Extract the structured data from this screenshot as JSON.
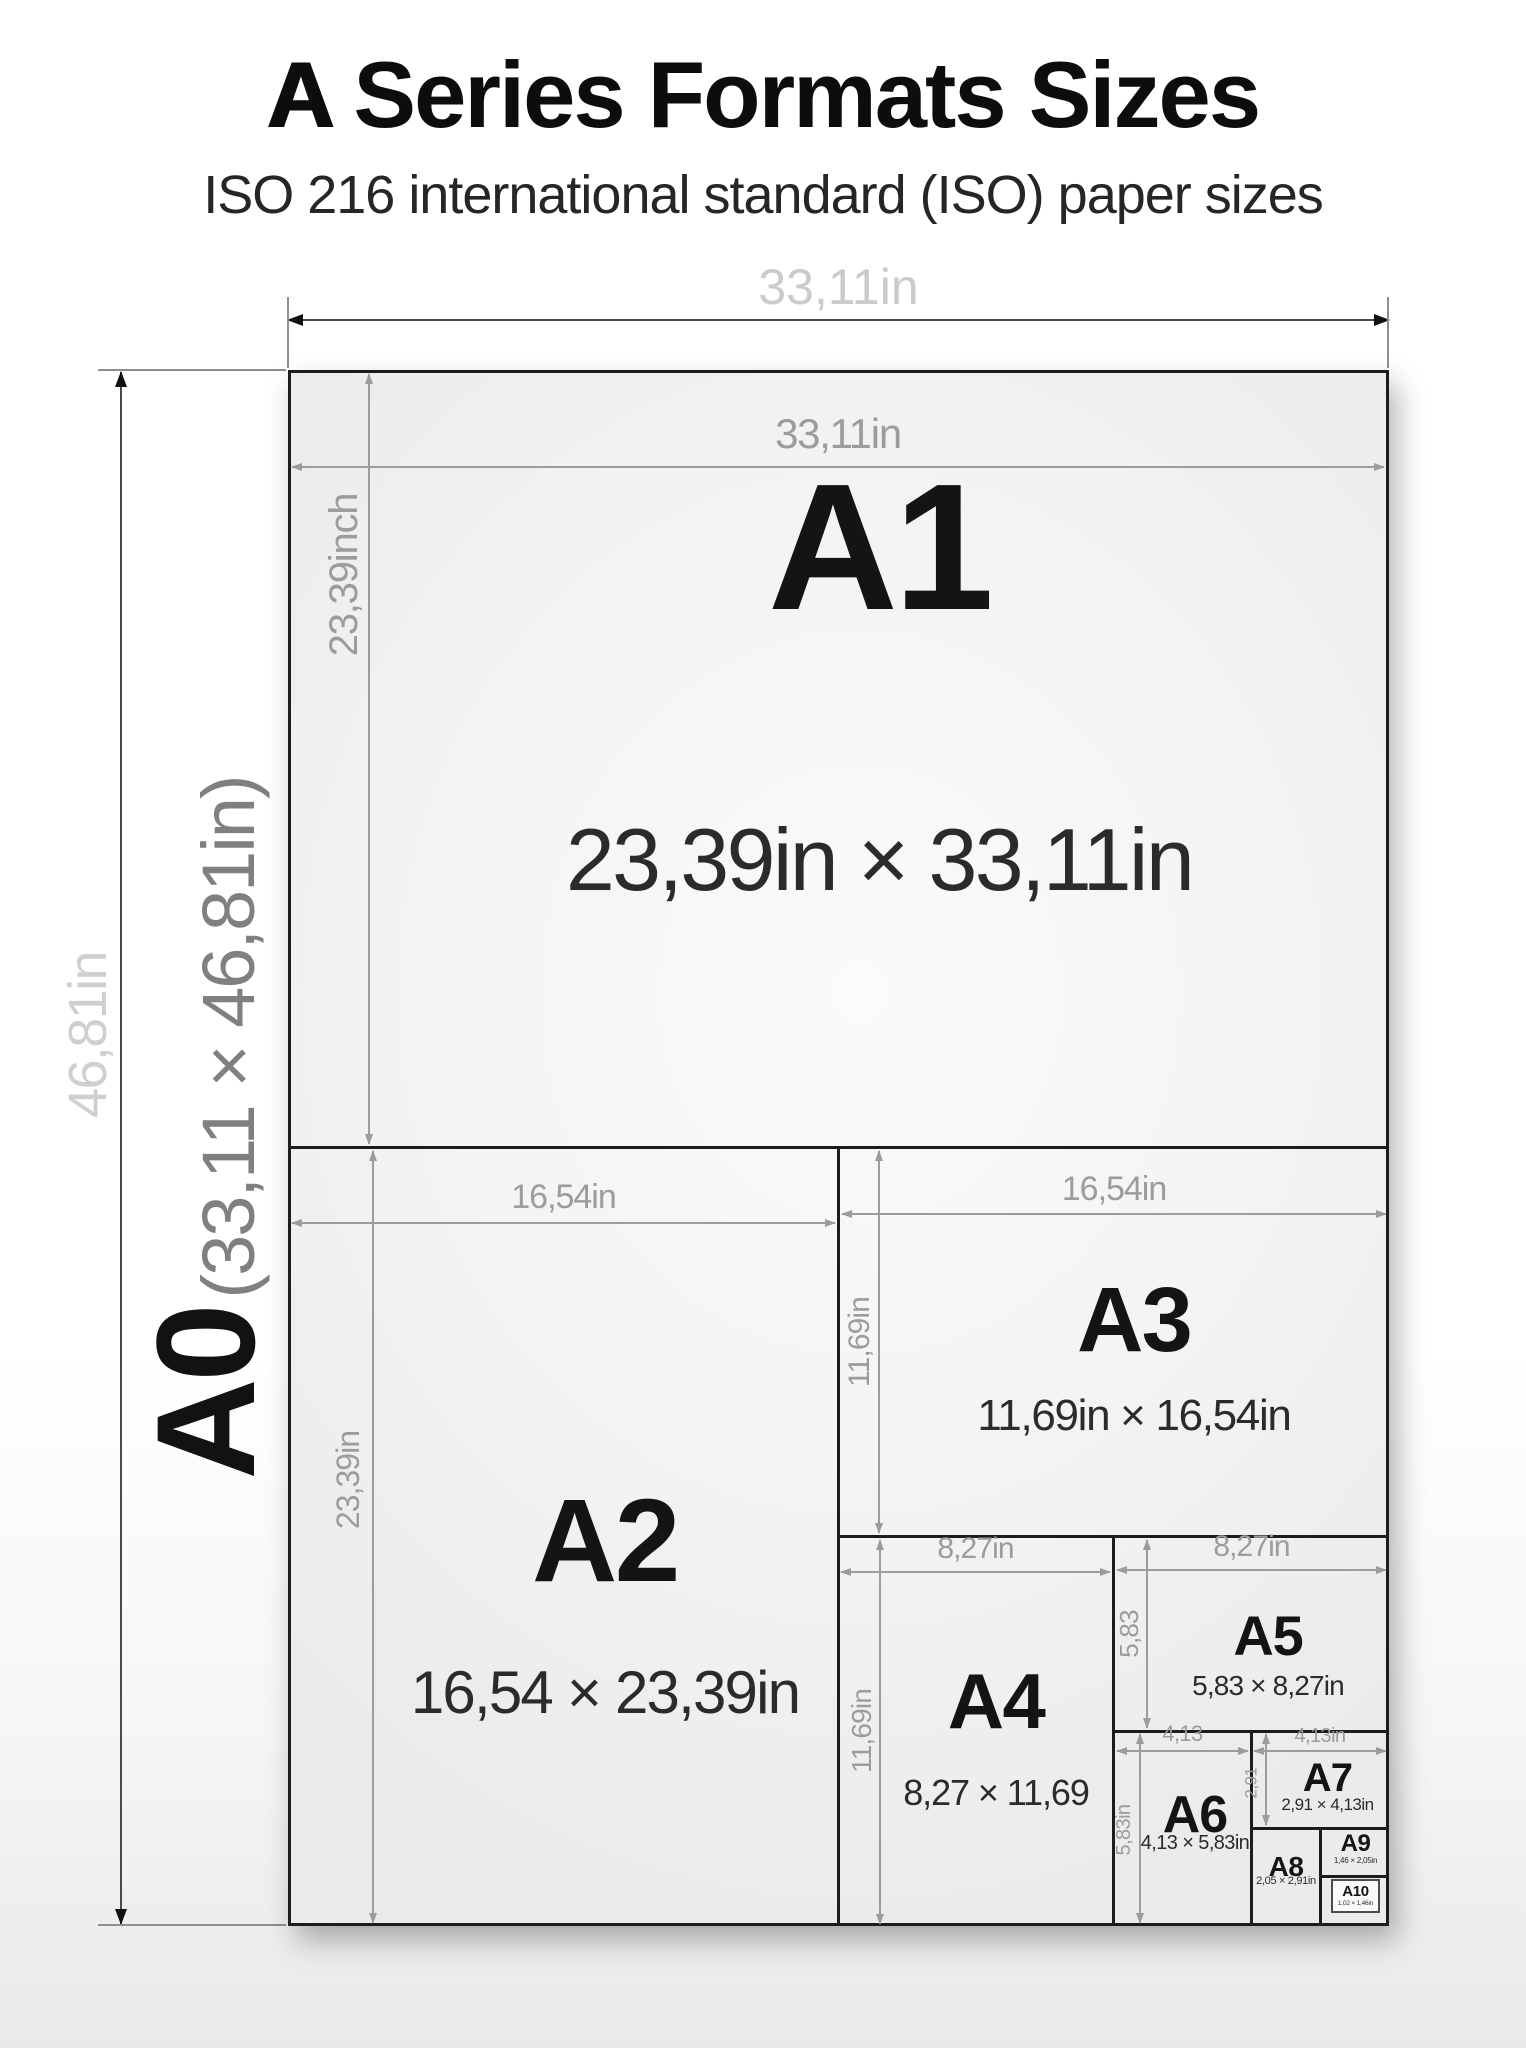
{
  "title": {
    "prefix": "A",
    "rest": " Series Formats Sizes"
  },
  "subtitle": "ISO 216 international standard (ISO) paper sizes",
  "outer": {
    "width_label": "33,11in",
    "height_label": "46,81in",
    "format": {
      "name": "A0",
      "dims": "(33,11 × 46,81in)"
    }
  },
  "formats": {
    "a1": {
      "name": "A1",
      "dims": "23,39in × 33,11in",
      "width_label": "33,11in",
      "height_label": "23,39inch"
    },
    "a2": {
      "name": "A2",
      "dims": "16,54 × 23,39in",
      "width_label": "16,54in",
      "height_label": "23,39in"
    },
    "a3": {
      "name": "A3",
      "dims": "11,69in × 16,54in",
      "width_label": "16,54in",
      "height_label": "11,69in"
    },
    "a4": {
      "name": "A4",
      "dims": "8,27 × 11,69",
      "width_label": "8,27in",
      "height_label": "11,69in"
    },
    "a5": {
      "name": "A5",
      "dims": "5,83 × 8,27in",
      "width_label": "8,27in",
      "height_label": "5,83"
    },
    "a6": {
      "name": "A6",
      "dims": "4,13 × 5,83in",
      "width_label": "4,13",
      "height_label": "5,83in"
    },
    "a7": {
      "name": "A7",
      "dims": "2,91 × 4,13in",
      "width_label": "4,13in",
      "height_label": "2,91"
    },
    "a8": {
      "name": "A8",
      "dims": "2,05 × 2,91in"
    },
    "a9": {
      "name": "A9",
      "dims": "1,46 × 2,05in"
    },
    "a10": {
      "name": "A10",
      "dims": "1,02 × 1,46in"
    }
  },
  "colors": {
    "ink": "#1c1c1c",
    "dim_gray": "#9c9c9c",
    "outer_label_gray": "#cbcbcb",
    "a0_dims_gray": "#808080",
    "sheet_fill": "#f3f3f3"
  }
}
